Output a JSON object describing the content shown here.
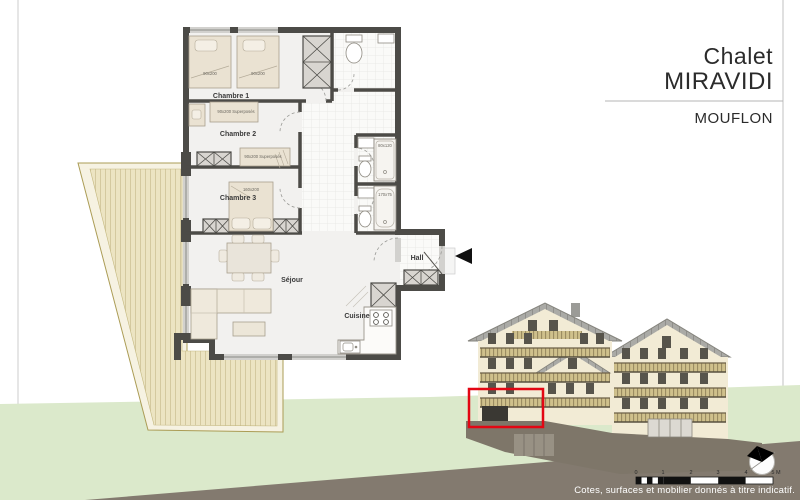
{
  "title_block": {
    "project": "Chalet",
    "name": "MIRAVIDI",
    "unit": "MOUFLON"
  },
  "plan": {
    "rooms": {
      "chambre1": "Chambre 1",
      "chambre2": "Chambre 2",
      "chambre3": "Chambre 3",
      "sejour": "Séjour",
      "cuisine": "Cuisine",
      "hall": "Hall"
    },
    "furniture": {
      "bed1": "90x200",
      "bed2": "90x200",
      "bunk1": "90x200 Superposés",
      "bunk2": "90x200 Superposés",
      "double_bed": "160x200",
      "shower": "80x120",
      "bathtub": "170x75"
    }
  },
  "scale_bar": {
    "labels": [
      "0",
      "1",
      "2",
      "3",
      "4",
      "5 M"
    ]
  },
  "footer": {
    "disclaimer": "Cotes, surfaces et mobilier donnés à titre indicatif."
  },
  "colors": {
    "highlight_red": "#e30613",
    "wall_dark": "#4c4b47",
    "deck_wood": "#ece4c2",
    "hill_green": "#dbe9cb",
    "ground_brown": "#837a6f",
    "facade_cream": "#f2ebd5"
  }
}
